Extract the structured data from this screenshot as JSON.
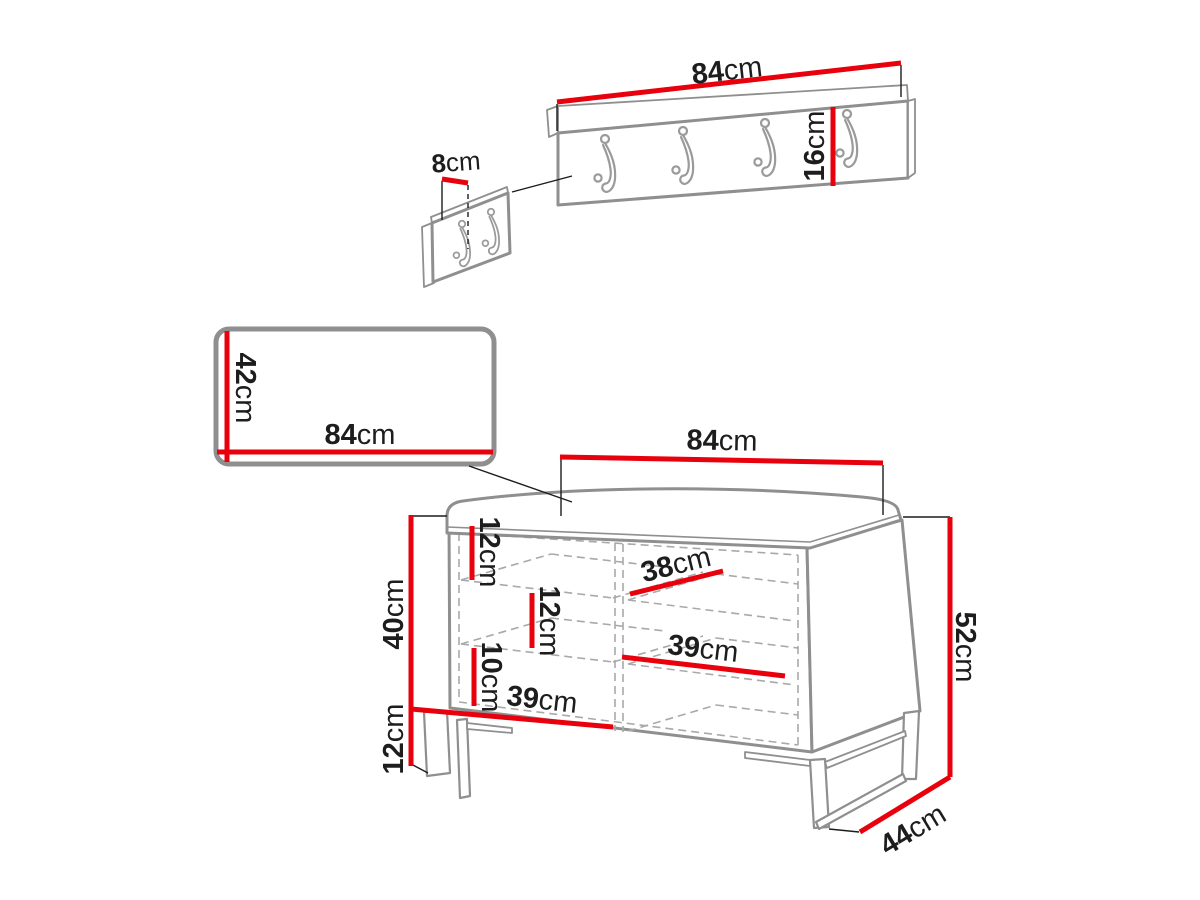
{
  "diagram": {
    "type": "furniture-dimension-drawing",
    "unit": "cm",
    "hanger_hook_count": 4,
    "detail_hook_count": 2
  },
  "colors": {
    "accent": "#e8000d",
    "outline": "#8f8f8f",
    "dashed": "#a9a9a9",
    "text": "#1d1d1d"
  },
  "dims": {
    "hanger_width": {
      "value": "84",
      "unit": "cm"
    },
    "hanger_height": {
      "value": "16",
      "unit": "cm"
    },
    "hook_spacing": {
      "value": "8",
      "unit": "cm"
    },
    "mirror_height": {
      "value": "42",
      "unit": "cm"
    },
    "mirror_width": {
      "value": "84",
      "unit": "cm"
    },
    "bench_width": {
      "value": "84",
      "unit": "cm"
    },
    "bench_total_height": {
      "value": "52",
      "unit": "cm"
    },
    "bench_depth": {
      "value": "44",
      "unit": "cm"
    },
    "bench_body_height": {
      "value": "40",
      "unit": "cm"
    },
    "bench_leg_height": {
      "value": "12",
      "unit": "cm"
    },
    "inner_top_gap": {
      "value": "12",
      "unit": "cm"
    },
    "inner_mid_gap": {
      "value": "12",
      "unit": "cm"
    },
    "inner_bottom_gap": {
      "value": "10",
      "unit": "cm"
    },
    "shelf_depth": {
      "value": "38",
      "unit": "cm"
    },
    "right_shelf_width": {
      "value": "39",
      "unit": "cm"
    },
    "left_shelf_width": {
      "value": "39",
      "unit": "cm"
    }
  }
}
